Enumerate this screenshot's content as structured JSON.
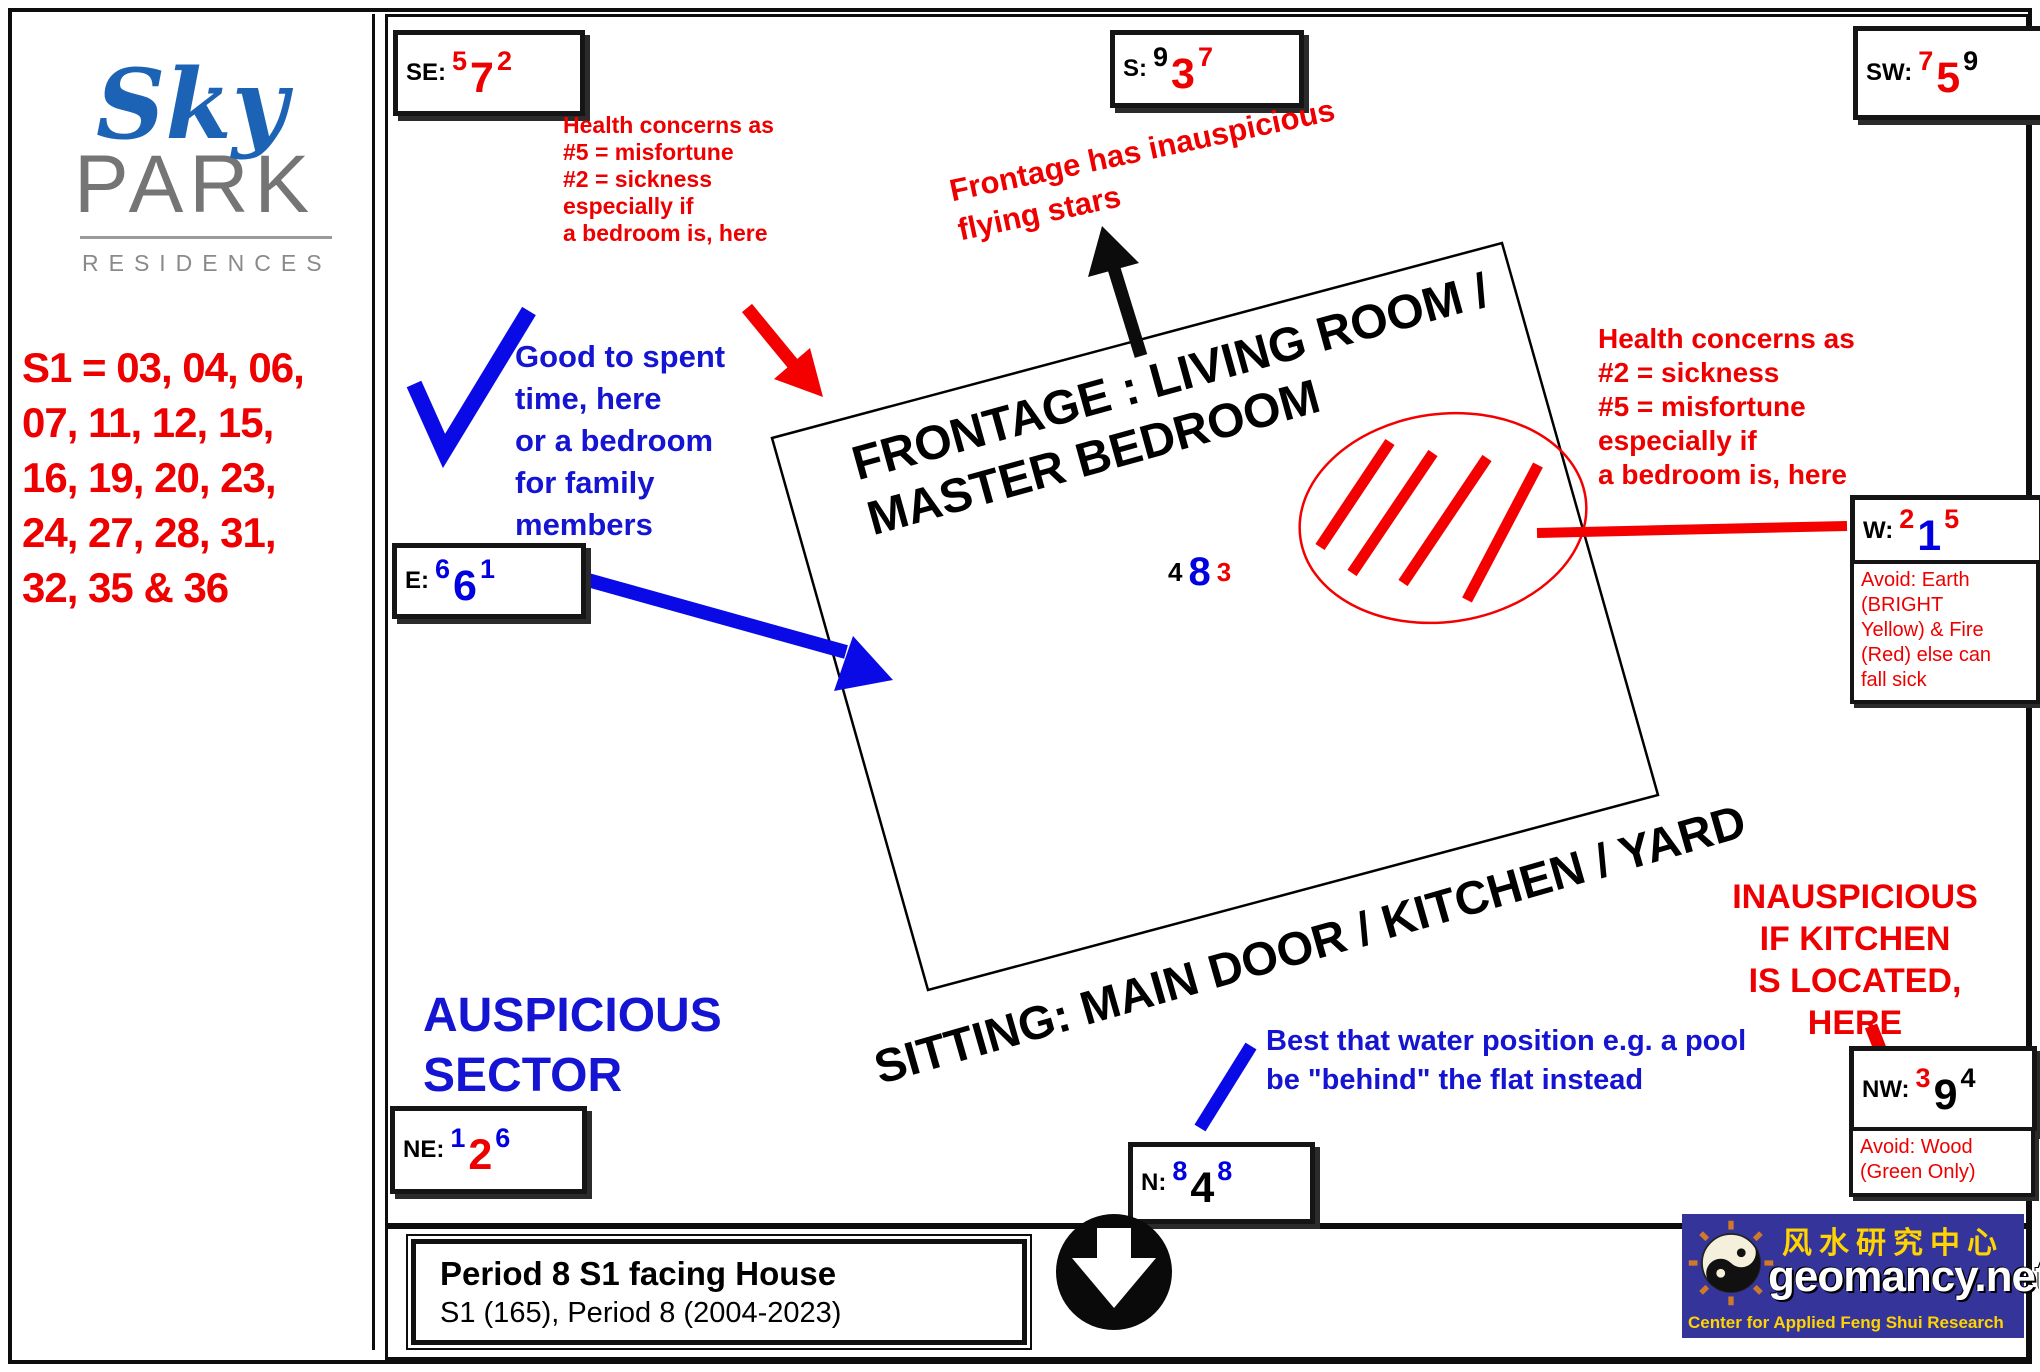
{
  "sidebar": {
    "logo": {
      "word_sky": "Sky",
      "word_park": "PARK",
      "word_residences": "RESIDENCES"
    },
    "s1_units": "S1 = 03, 04, 06,\n07, 11, 12, 15,\n16, 19, 20, 23,\n24, 27, 28, 31,\n32, 35 & 36"
  },
  "compass": {
    "se": {
      "label": "SE:",
      "stars": [
        "5",
        "7",
        "2"
      ],
      "star_colors": [
        "red",
        "red",
        "red"
      ]
    },
    "s": {
      "label": "S:",
      "stars": [
        "9",
        "3",
        "7"
      ],
      "star_colors": [
        "black",
        "red",
        "red"
      ]
    },
    "sw": {
      "label": "SW:",
      "stars": [
        "7",
        "5",
        "9"
      ],
      "star_colors": [
        "red",
        "red",
        "black"
      ]
    },
    "e": {
      "label": "E:",
      "stars": [
        "6",
        "6",
        "1"
      ],
      "star_colors": [
        "blue",
        "blue",
        "blue"
      ]
    },
    "w": {
      "label": "W:",
      "stars": [
        "2",
        "1",
        "5"
      ],
      "star_colors": [
        "red",
        "blue",
        "red"
      ]
    },
    "ne": {
      "label": "NE:",
      "stars": [
        "1",
        "2",
        "6"
      ],
      "star_colors": [
        "blue",
        "red",
        "blue"
      ]
    },
    "n": {
      "label": "N:",
      "stars": [
        "8",
        "4",
        "8"
      ],
      "star_colors": [
        "blue",
        "black",
        "blue"
      ]
    },
    "nw": {
      "label": "NW:",
      "stars": [
        "3",
        "9",
        "4"
      ],
      "star_colors": [
        "red",
        "black",
        "black"
      ]
    },
    "center_stars": [
      "4",
      "8",
      "3"
    ],
    "center_star_colors": [
      "black",
      "blue",
      "red"
    ]
  },
  "house": {
    "frontage_label": "FRONTAGE : LIVING ROOM / MASTER BEDROOM",
    "sitting_label": "SITTING: MAIN DOOR / KITCHEN / YARD"
  },
  "annotations": {
    "se_health": "Health concerns as\n#5 = misfortune\n#2 = sickness\nespecially if\na bedroom is, here",
    "good_sector_note": "Good to spent\ntime, here\nor a bedroom\nfor family\nmembers",
    "frontage_warning": "Frontage has inauspicious\nflying stars",
    "w_health": "Health concerns as\n#2 = sickness\n#5 = misfortune\nespecially if\na bedroom is, here",
    "w_avoid": "Avoid: Earth\n(BRIGHT\nYellow) & Fire\n(Red) else can\nfall sick",
    "auspicious_sector": "AUSPICIOUS\nSECTOR",
    "water_note": "Best that water position e.g. a pool\nbe \"behind\" the flat instead",
    "kitchen_warning": "INAUSPICIOUS\nIF KITCHEN\nIS LOCATED,\nHERE",
    "nw_avoid": "Avoid: Wood\n(Green Only)"
  },
  "footer": {
    "title": "Period 8 S1 facing House",
    "subtitle": "S1 (165), Period 8 (2004-2023)"
  },
  "brand": {
    "chinese_title": "风水研究中心",
    "site_name": "geomancy.net",
    "tagline": "Center for Applied Feng Shui Research"
  },
  "colors": {
    "inauspicious_red": "#ee0000",
    "auspicious_blue": "#1414d2",
    "neutral_black": "#000000",
    "brand_bg_blue": "#34349a",
    "brand_yellow": "#ffd400"
  }
}
